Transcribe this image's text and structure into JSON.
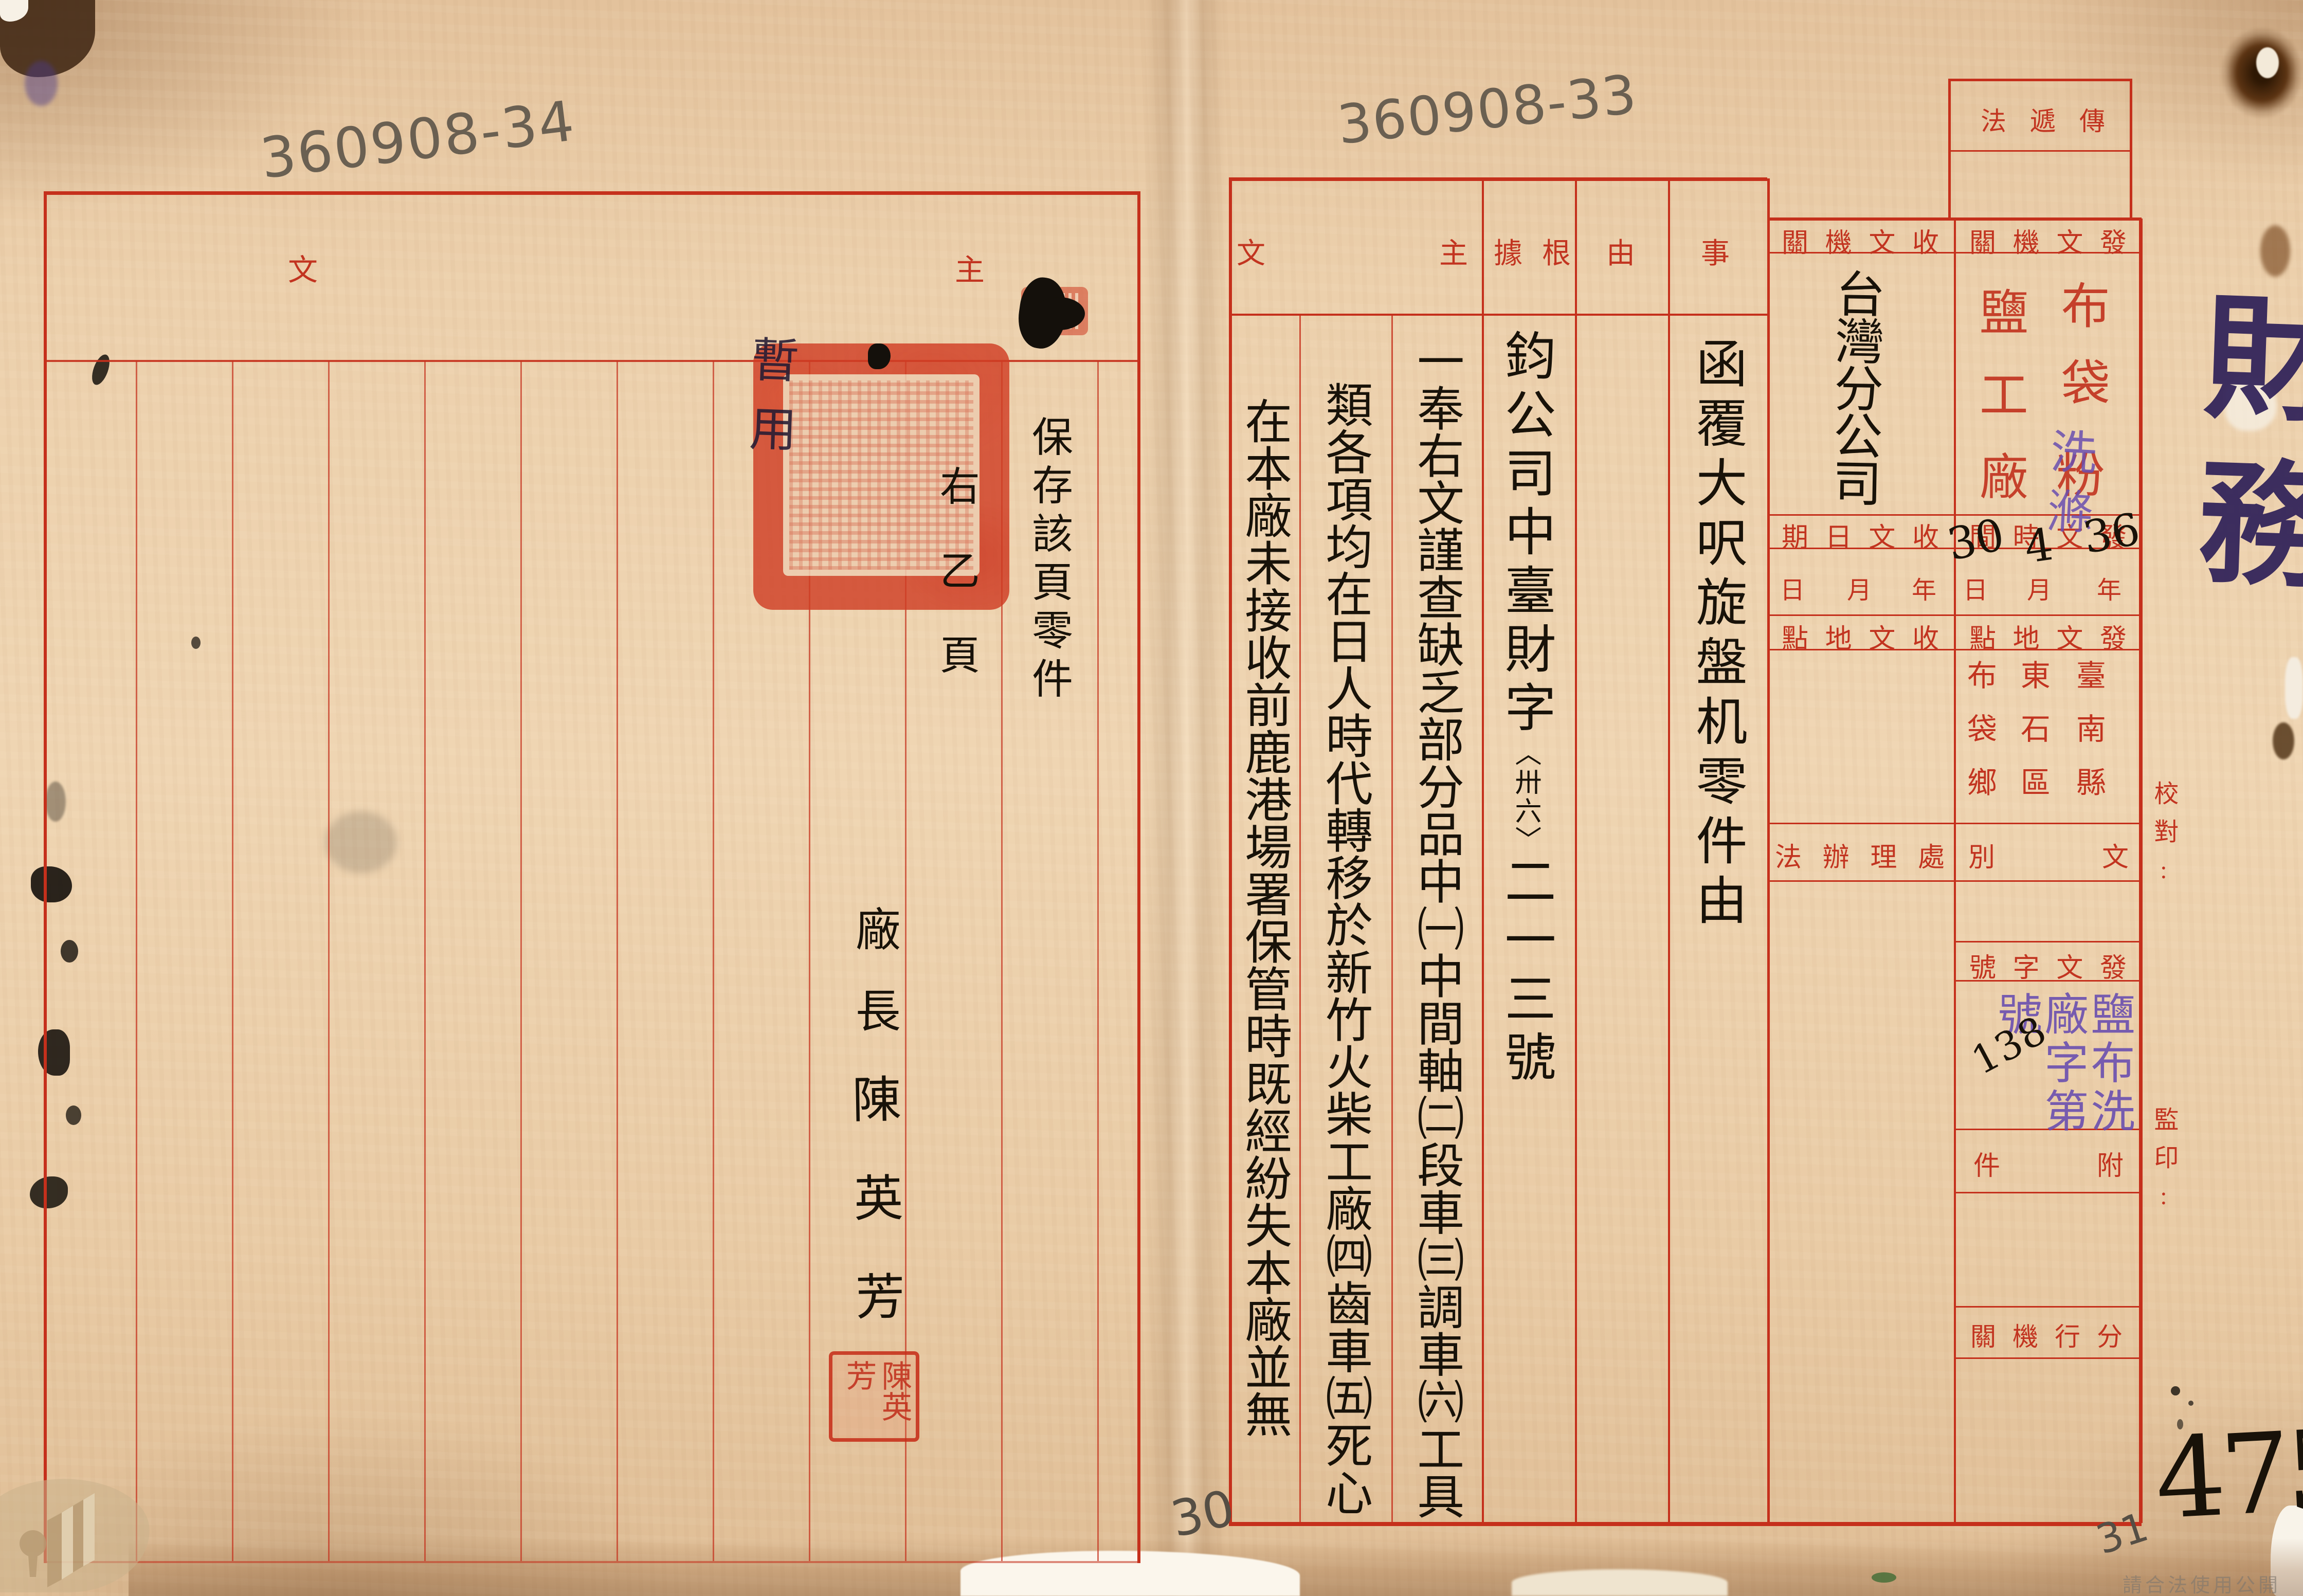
{
  "page": {
    "archive_number_left": "360908-34",
    "archive_number_right": "360908-33",
    "sheet_number_left": "30",
    "sheet_number_right": "31",
    "folio_number": "475",
    "category_note": "財務",
    "usage_watermark": "請合法使用公開之影像"
  },
  "left_page": {
    "header_main": "主文",
    "preserve_note": "保存該頁零件",
    "page_note": "右乙頁",
    "signer_title": "廠長",
    "signer_name": "陳英芳",
    "name_seal": "陳英芳",
    "edge_annotation": "暫用"
  },
  "right_page": {
    "headers": {
      "subject_1": "事",
      "subject_2": "由",
      "basis": "根據",
      "main": "主文"
    },
    "body": {
      "subject": "函覆大呎旋盤机零件由",
      "basis_head": "鈞公司中臺財字",
      "basis_note": "〈卅六〉",
      "basis_tail": "二一三號",
      "main_1": "一奉右文謹查缺乏部分品中㈠中間軸㈡段車㈢調車㈥工具",
      "main_2": "類各項均在日人時代轉移於新竹火柴工廠㈣齒車㈤死心",
      "main_3": "在本廠未接收前鹿港場署保管時既經紛失本廠並無"
    },
    "form": {
      "delivery_label": "傳遞法",
      "send_org_label": "發文機關",
      "recv_org_label": "收文機關",
      "send_org_stamp_col1": "布袋",
      "send_org_stamp_extra": "粉",
      "send_org_stamp_col2": "鹽工廠",
      "send_org_overlay": "洗滌",
      "recv_org_value": "台灣分公司",
      "send_time_label": "發文時間",
      "recv_date_label": "收文日期",
      "date_units": [
        "年",
        "月",
        "日"
      ],
      "send_date": {
        "year": "36",
        "month": "4",
        "day": "30"
      },
      "send_place_label": "發文地點",
      "recv_place_label": "收文地點",
      "send_place_value": [
        "臺南縣",
        "東石區",
        "布袋鄉"
      ],
      "doc_type_label": "文別",
      "handling_label": "處理辦法",
      "doc_no_label": "發文字號",
      "doc_no_stamp": {
        "text": "鹽布洗廠字第號",
        "number": "138"
      },
      "attachment_label": "附件",
      "branch_label": "分行機關",
      "proofread_label": "校對:",
      "stamp_label": "監印:"
    }
  }
}
